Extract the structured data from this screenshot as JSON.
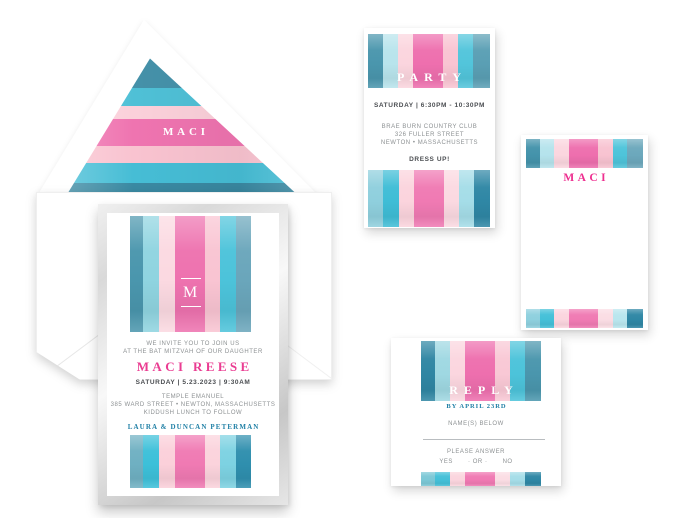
{
  "palette": {
    "slate_teal": "#4a96ad",
    "turquoise": "#4cc3da",
    "pale_blue": "#aadfe9",
    "blush": "#f9c4d2",
    "pink": "#ee6fae",
    "dark_teal": "#2f87a5",
    "magenta_text": "#ea3d92",
    "teal_text": "#2180a6",
    "gray_text": "#8d9193",
    "dark_text": "#4b4e52",
    "silver_frame": "#d9d9d9"
  },
  "envelope": {
    "liner_monogram": "MACI",
    "liner_stripes": [
      {
        "c": "#4591a9",
        "w": 31
      },
      {
        "c": "#4fc0d6",
        "w": 18
      },
      {
        "c": "#fbd0da",
        "w": 13
      },
      {
        "c": "#ef74b0",
        "w": 27
      },
      {
        "c": "#f9c3d0",
        "w": 17
      },
      {
        "c": "#46bdd5",
        "w": 20
      },
      {
        "c": "#3a89a2",
        "w": 20
      }
    ]
  },
  "invitation": {
    "monogram": "M",
    "intro_line1": "WE INVITE YOU TO JOIN US",
    "intro_line2": "AT THE BAT MITZVAH OF OUR DAUGHTER",
    "honoree": "MACI REESE",
    "datetime": "SATURDAY | 5.23.2023 | 9:30AM",
    "venue": "TEMPLE EMANUEL",
    "address": "385 WARD STREET • NEWTON, MASSACHUSETTS",
    "note": "KIDDUSH LUNCH TO FOLLOW",
    "hosts": "LAURA & DUNCAN PETERMAN",
    "top_stripes": [
      {
        "c": "#4a96ad",
        "w": 13
      },
      {
        "c": "#8fd4e0",
        "w": 16
      },
      {
        "c": "#fbd9e1",
        "w": 16
      },
      {
        "c": "#ee72af",
        "w": 30
      },
      {
        "c": "#f9c4d2",
        "w": 15
      },
      {
        "c": "#4cc3da",
        "w": 16
      },
      {
        "c": "#6aa6bb",
        "w": 15
      }
    ],
    "bottom_stripes": [
      {
        "c": "#6fb0c2",
        "w": 13
      },
      {
        "c": "#3cc0d9",
        "w": 16
      },
      {
        "c": "#fbd0da",
        "w": 16
      },
      {
        "c": "#f07ab3",
        "w": 30
      },
      {
        "c": "#fbd3dc",
        "w": 15
      },
      {
        "c": "#7dd2e2",
        "w": 16
      },
      {
        "c": "#2f8fae",
        "w": 15
      }
    ]
  },
  "party_card": {
    "title": "PARTY",
    "datetime": "SATURDAY | 6:30PM - 10:30PM",
    "venue": "BRAE BURN COUNTRY CLUB",
    "address": "326 FULLER STREET",
    "city": "NEWTON • MASSACHUSETTS",
    "note": "DRESS UP!",
    "top_stripes": [
      {
        "c": "#4a96ad",
        "w": 15
      },
      {
        "c": "#b8e4ec",
        "w": 15
      },
      {
        "c": "#fbd5de",
        "w": 15
      },
      {
        "c": "#ee6fae",
        "w": 30
      },
      {
        "c": "#f9c4d2",
        "w": 15
      },
      {
        "c": "#52c5db",
        "w": 15
      },
      {
        "c": "#5a9fb4",
        "w": 17
      }
    ],
    "bottom_stripes": [
      {
        "c": "#8fcfdd",
        "w": 15
      },
      {
        "c": "#3fbdd6",
        "w": 16
      },
      {
        "c": "#fbd4dd",
        "w": 15
      },
      {
        "c": "#f07ab3",
        "w": 30
      },
      {
        "c": "#fbd9e1",
        "w": 15
      },
      {
        "c": "#a5dde8",
        "w": 15
      },
      {
        "c": "#2f87a5",
        "w": 16
      }
    ]
  },
  "note_card": {
    "name": "MACI",
    "top_stripes": [
      {
        "c": "#4493ab",
        "w": 14
      },
      {
        "c": "#b5e3ec",
        "w": 15
      },
      {
        "c": "#fbd6df",
        "w": 15
      },
      {
        "c": "#ee6fae",
        "w": 30
      },
      {
        "c": "#f8c3d1",
        "w": 15
      },
      {
        "c": "#4ec4da",
        "w": 15
      },
      {
        "c": "#6ca8bc",
        "w": 16
      }
    ],
    "bottom_stripes": [
      {
        "c": "#8ed0de",
        "w": 14
      },
      {
        "c": "#44c0d8",
        "w": 15
      },
      {
        "c": "#fbd5de",
        "w": 15
      },
      {
        "c": "#f07ab3",
        "w": 30
      },
      {
        "c": "#fbdde4",
        "w": 15
      },
      {
        "c": "#b9e6ee",
        "w": 15
      },
      {
        "c": "#2f87a5",
        "w": 16
      }
    ]
  },
  "reply_card": {
    "title": "REPLY",
    "deadline": "BY APRIL 23RD",
    "name_label": "NAME(S) BELOW",
    "answer_label": "PLEASE ANSWER",
    "option_yes": "YES",
    "option_or": "· OR ·",
    "option_no": "NO",
    "top_stripes": [
      {
        "c": "#2f86a3",
        "w": 14
      },
      {
        "c": "#9fd8e2",
        "w": 15
      },
      {
        "c": "#fbd6df",
        "w": 15
      },
      {
        "c": "#ee6fae",
        "w": 30
      },
      {
        "c": "#f9c8d5",
        "w": 15
      },
      {
        "c": "#4cc3da",
        "w": 15
      },
      {
        "c": "#4a96ad",
        "w": 16
      }
    ],
    "bottom_stripes": [
      {
        "c": "#7cc8d6",
        "w": 14
      },
      {
        "c": "#44c0d8",
        "w": 15
      },
      {
        "c": "#fbd5de",
        "w": 15
      },
      {
        "c": "#f07ab3",
        "w": 30
      },
      {
        "c": "#fbdde4",
        "w": 15
      },
      {
        "c": "#a5dde8",
        "w": 15
      },
      {
        "c": "#2f87a5",
        "w": 16
      }
    ]
  }
}
